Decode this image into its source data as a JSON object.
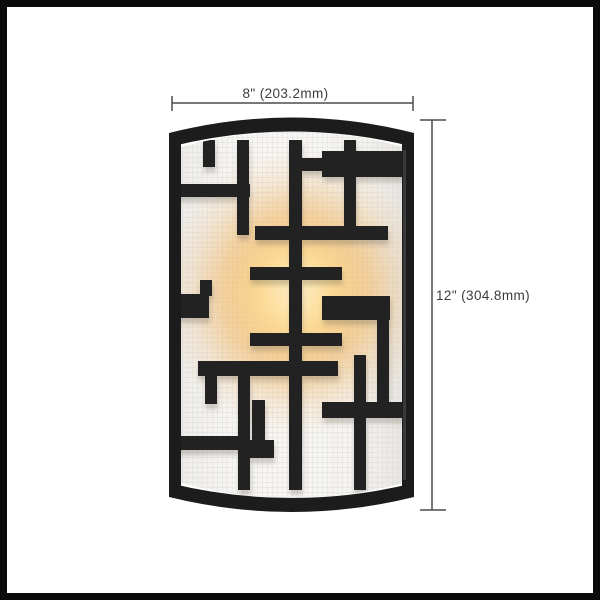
{
  "page": {
    "background_color": "#ffffff",
    "image_border_color": "#0b0b0b"
  },
  "diagram": {
    "subject": "wall-sconce-front-view",
    "width_dimension": {
      "label": "8\" (203.2mm)",
      "inches": 8,
      "millimeters": 203.2
    },
    "height_dimension": {
      "label": "12\" (304.8mm)",
      "inches": 12,
      "millimeters": 304.8
    },
    "style": {
      "dimension_line_color": "#4b4b4b",
      "dimension_text_color": "#3c3c3c"
    }
  },
  "fixture": {
    "frame_color": "#1c1c1c",
    "bar_color": "#222222",
    "shade_color": "#f3f2ef",
    "shade_edge_color": "#d9d6d1",
    "glow_core_color": "#ffeec6",
    "glow_mid_color": "#f0b35c"
  }
}
